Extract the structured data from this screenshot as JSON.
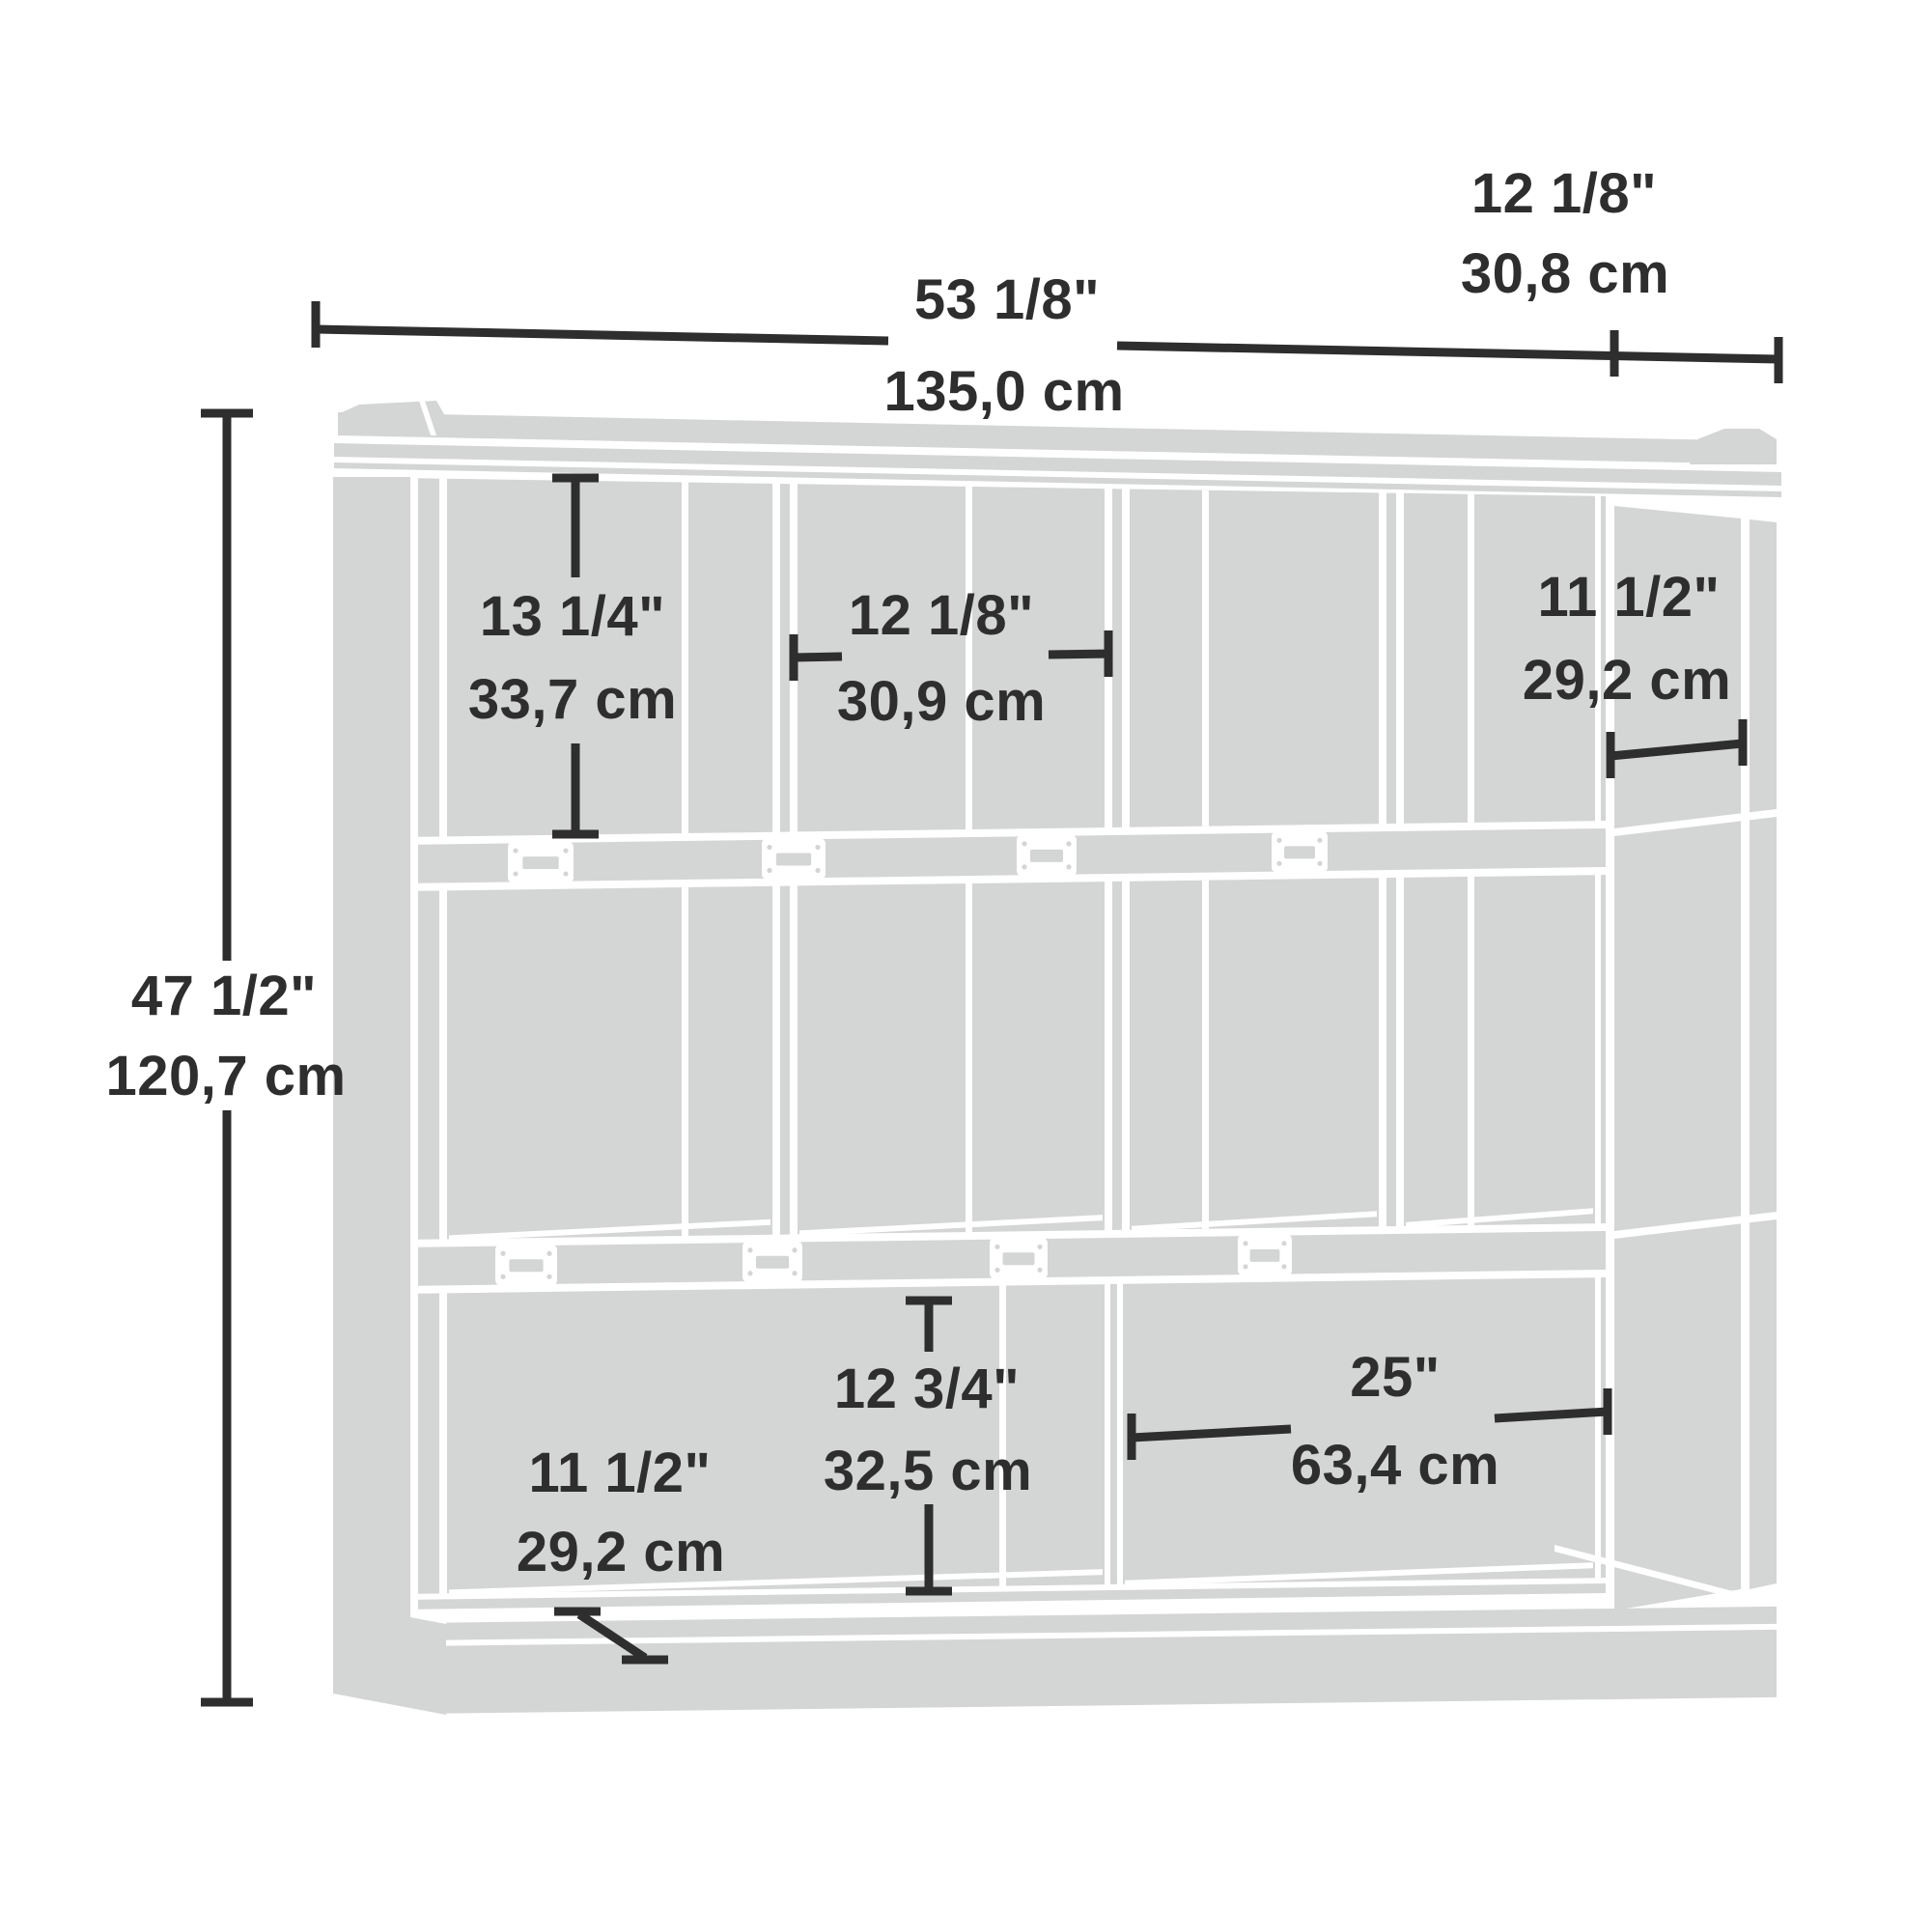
{
  "diagram_type": "furniture-dimension-drawing",
  "subject": "cubby storage bookcase",
  "labels": {
    "depth_top": {
      "in": "12 1/8\"",
      "cm": "30,8 cm"
    },
    "width_top": {
      "in": "53 1/8\"",
      "cm": "135,0 cm"
    },
    "height_left": {
      "in": "47 1/2\"",
      "cm": "120,7 cm"
    },
    "cubby_top_height": {
      "in": "13 1/4\"",
      "cm": "33,7 cm"
    },
    "cubby_top_width": {
      "in": "12 1/8\"",
      "cm": "30,9 cm"
    },
    "cubby_top_depth": {
      "in": "11 1/2\"",
      "cm": "29,2 cm"
    },
    "cubby_bottom_height": {
      "in": "12 3/4\"",
      "cm": "32,5 cm"
    },
    "cubby_bottom_depth": {
      "in": "11 1/2\"",
      "cm": "29,2 cm"
    },
    "cubby_bottom_width": {
      "in": "25\"",
      "cm": "63,4 cm"
    }
  },
  "colors": {
    "furniture": "#d4d5d5",
    "line": "#2e2e2e",
    "background": "#ffffff"
  }
}
